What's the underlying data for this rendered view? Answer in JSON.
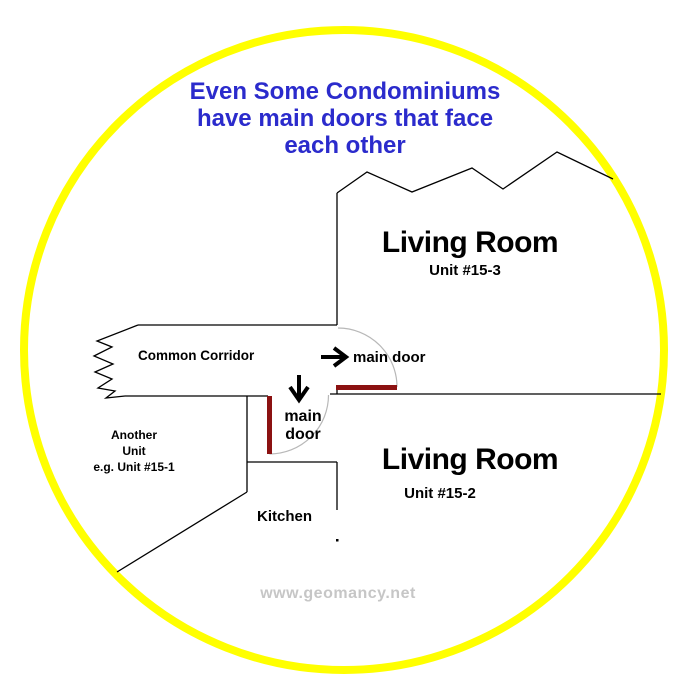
{
  "title": {
    "line1": "Even Some Condominiums",
    "line2": "have main doors that face",
    "line3": "each other"
  },
  "diagram": {
    "corridor_label": "Common Corridor",
    "unit_top": {
      "room": "Living Room",
      "unit": "Unit #15-3",
      "door_label": "main door"
    },
    "unit_bottom": {
      "room": "Living Room",
      "unit": "Unit #15-2",
      "door_label_line1": "main",
      "door_label_line2": "door"
    },
    "another_unit": {
      "line1": "Another",
      "line2": "Unit",
      "line3": "e.g. Unit #15-1"
    },
    "kitchen_label": "Kitchen"
  },
  "icons": {
    "top_door_direction": "arrow-right",
    "bottom_door_direction": "arrow-down"
  },
  "watermark": "www.geomancy.net",
  "colors": {
    "circle": "#FFFF00",
    "wall": "#000000",
    "door": "#8B1111",
    "swing_arc": "#B8B8B8",
    "title_text": "#2B2BCC",
    "watermark_text": "#C6C6C6"
  }
}
